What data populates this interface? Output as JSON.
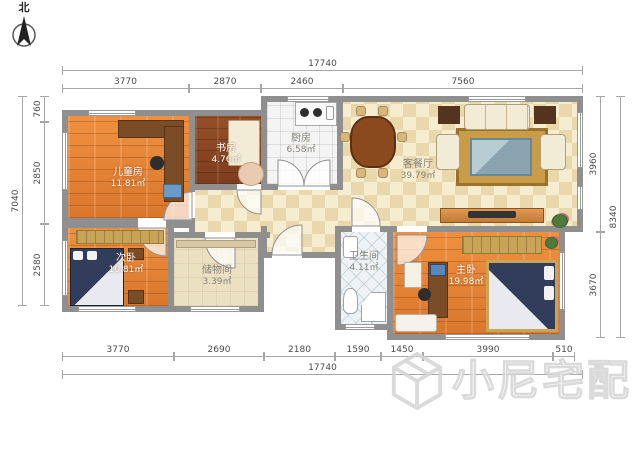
{
  "north": {
    "label": "北"
  },
  "watermark": {
    "text": "小尼宅配"
  },
  "rooms": [
    {
      "name": "儿童房",
      "area": "11.81㎡"
    },
    {
      "name": "书房",
      "area": "4.76㎡"
    },
    {
      "name": "厨房",
      "area": "6.58㎡"
    },
    {
      "name": "客餐厅",
      "area": "39.79㎡"
    },
    {
      "name": "次卧",
      "area": "10.81㎡"
    },
    {
      "name": "储物间",
      "area": "3.39㎡"
    },
    {
      "name": "卫生间",
      "area": "4.11㎡"
    },
    {
      "name": "主卧",
      "area": "19.98㎡"
    }
  ],
  "dims": {
    "top": {
      "total": "17740",
      "segments": [
        "3770",
        "2870",
        "2460",
        "7560"
      ]
    },
    "bottom": {
      "total": "17740",
      "segments": [
        "3770",
        "2690",
        "2180",
        "1590",
        "1450",
        "3990",
        "510"
      ]
    },
    "left": {
      "total": "7040",
      "segments": [
        "760",
        "2850",
        "2580"
      ]
    },
    "right": {
      "total": "8340",
      "segments": [
        "3960",
        "3670"
      ]
    }
  },
  "colors": {
    "wall": "#8f8f8f",
    "wood_floor": "#e07b33",
    "living_tile": "#eddcb3",
    "bed": "#2b3550",
    "wardrobe": "#c8a458"
  }
}
